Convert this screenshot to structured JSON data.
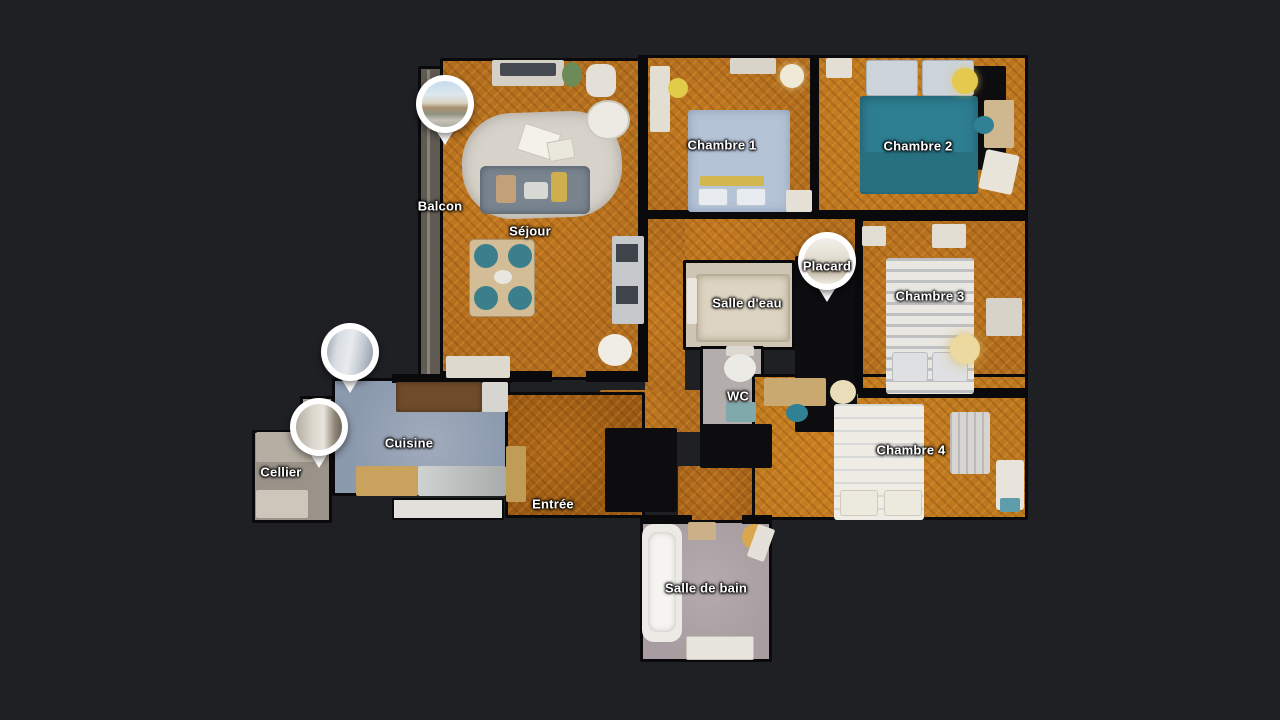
{
  "viewer": {
    "type": "3d-floorplan-top-view",
    "background": "#1e2024"
  },
  "floorplan": {
    "rooms": [
      {
        "id": "balcon",
        "label": "Balcon"
      },
      {
        "id": "sejour",
        "label": "Séjour"
      },
      {
        "id": "chambre-1",
        "label": "Chambre 1"
      },
      {
        "id": "chambre-2",
        "label": "Chambre 2"
      },
      {
        "id": "placard",
        "label": "Placard"
      },
      {
        "id": "salle-deau",
        "label": "Salle d'eau"
      },
      {
        "id": "chambre-3",
        "label": "Chambre 3"
      },
      {
        "id": "wc",
        "label": "WC"
      },
      {
        "id": "chambre-4",
        "label": "Chambre 4"
      },
      {
        "id": "cuisine",
        "label": "Cuisine"
      },
      {
        "id": "cellier",
        "label": "Cellier"
      },
      {
        "id": "entree",
        "label": "Entrée"
      },
      {
        "id": "salle-de-bain",
        "label": "Salle de bain"
      }
    ],
    "panorama_markers": [
      {
        "id": "pano-balcon"
      },
      {
        "id": "pano-cuisine-balcony"
      },
      {
        "id": "pano-cellier"
      },
      {
        "id": "pano-placard"
      }
    ],
    "colors": {
      "background": "#1e2024",
      "wall": "#0a0a0c",
      "parquet_floor": "#b26e1e",
      "entry_floor": "#9a5a14",
      "kitchen_floor": "#8c9aae",
      "bathroom_floor": "#a89da1",
      "shower_floor": "#ded4c2",
      "cellar_floor": "#9a9389",
      "bed_1": "#b5c3d6",
      "bed_2": "#2e7e92",
      "bed_3": "#e9e7e2",
      "bed_4": "#efece5",
      "label_text": "#ffffff",
      "marker_ring": "#ffffff"
    }
  }
}
